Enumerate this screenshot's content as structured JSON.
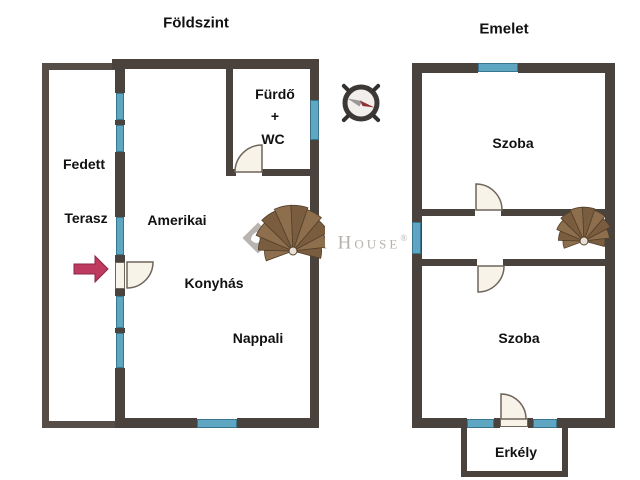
{
  "ground": {
    "title": "Földszint",
    "terrace": [
      "Fedett",
      "Terasz"
    ],
    "living": [
      "Amerikai",
      "Konyhás",
      "Nappali"
    ],
    "bath": [
      "Fürdő",
      "+",
      "WC"
    ]
  },
  "upper": {
    "title": "Emelet",
    "room_top": "Szoba",
    "room_bottom": "Szoba",
    "balcony": "Erkély"
  },
  "watermark": {
    "name": "Duna House",
    "reg": "®"
  },
  "icons": {
    "compass": "compass-rose",
    "ground_stair": "spiral-staircase",
    "upper_stair": "spiral-staircase",
    "entrance": "entrance-arrow"
  },
  "colors": {
    "wall": "#4a423c",
    "wall_light": "#564d46",
    "window": "#5fa6c3",
    "window_border": "#39758f",
    "door": "#f8f3e9",
    "door_border": "#6e655c",
    "stair_dark": "#7a5d3f",
    "stair_light": "#8d6e4d",
    "stair_line": "#54402b",
    "arrow": "#bf3a5f",
    "arrow_border": "#8c2547",
    "watermark": "#b6b1ad"
  }
}
